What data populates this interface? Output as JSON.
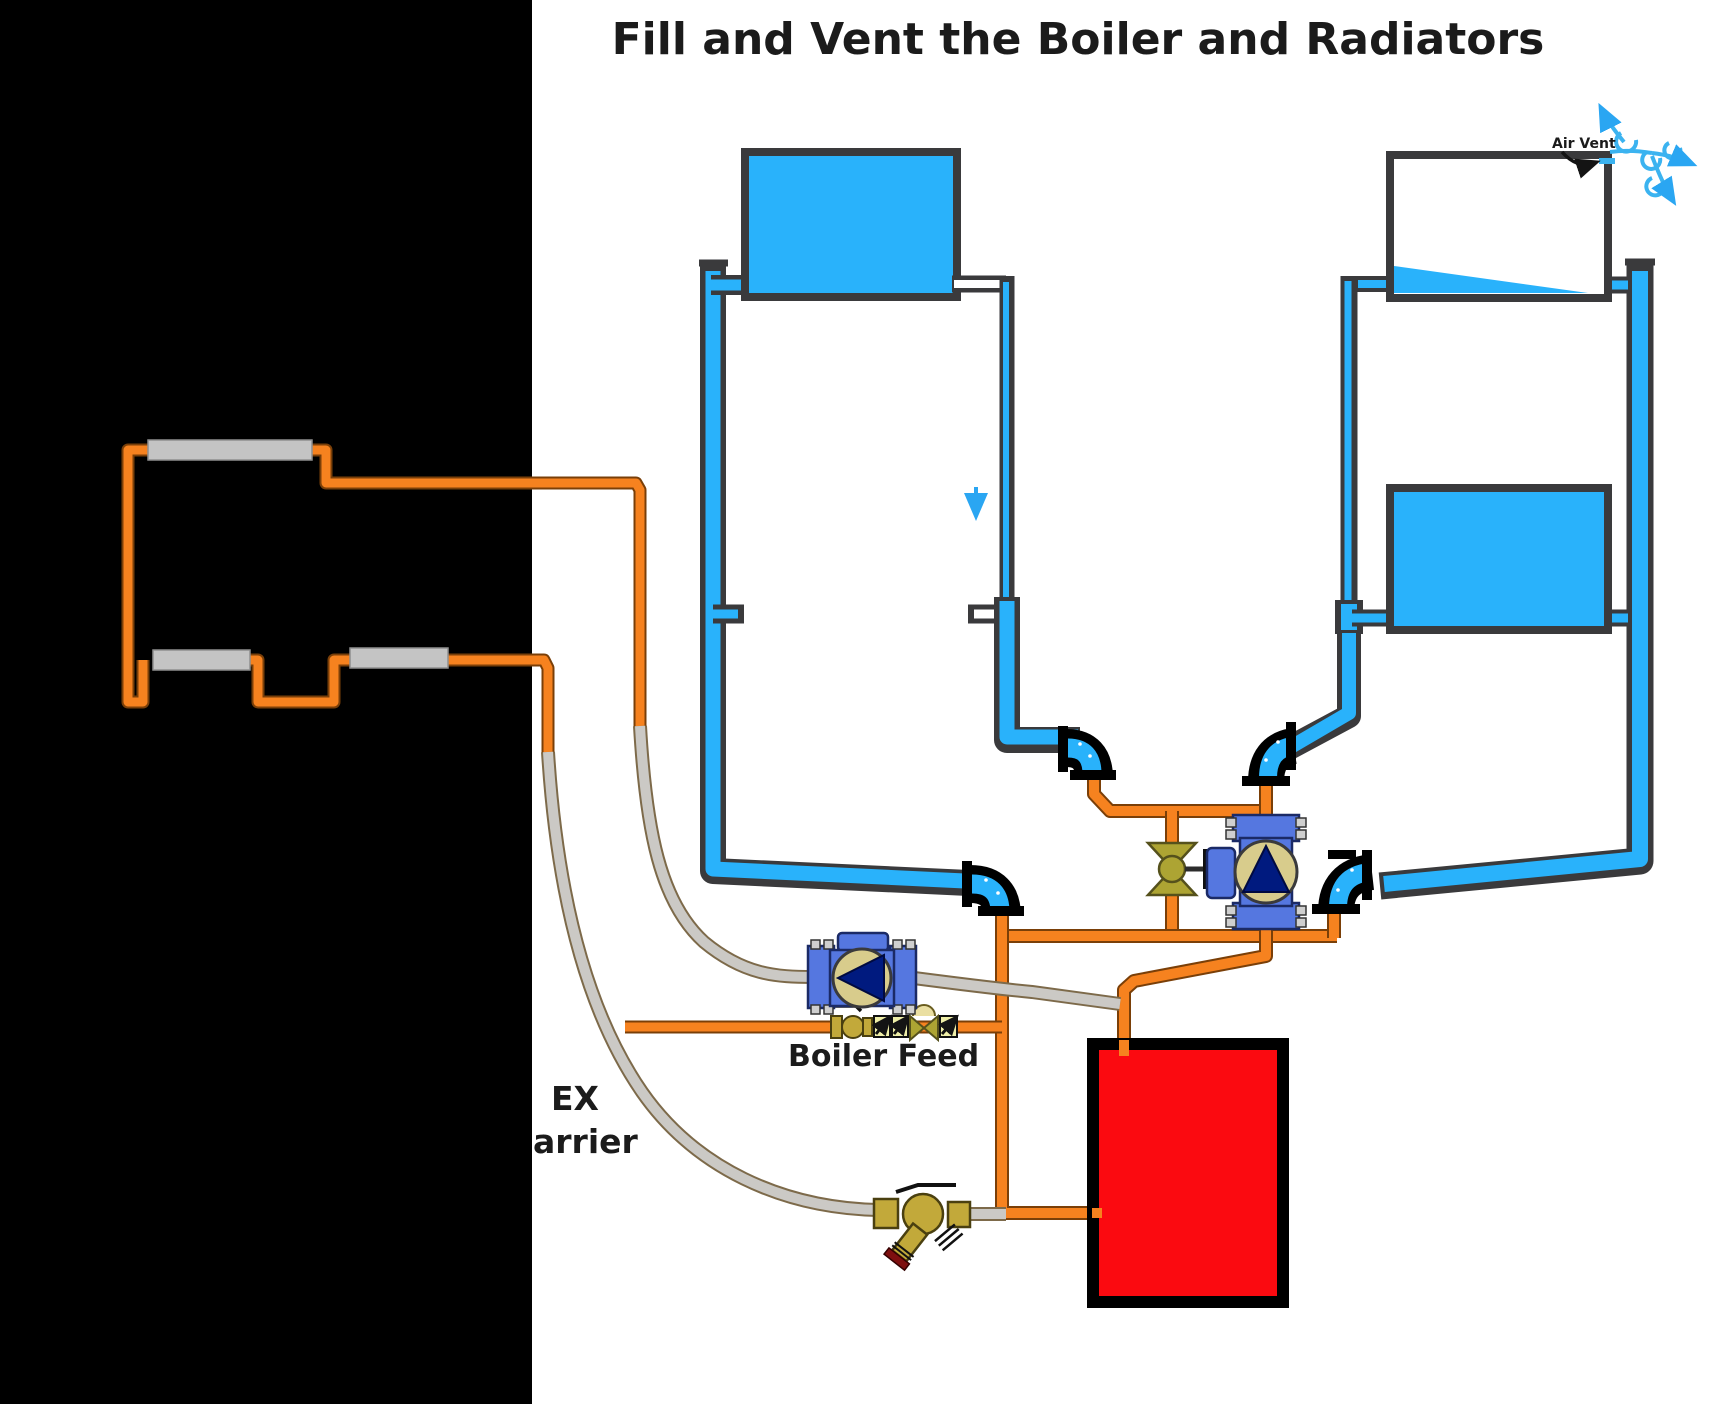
{
  "title": "Fill and Vent the Boiler and Radiators",
  "labels": {
    "air_vent": "Air Vent",
    "boiler_feed": "Boiler Feed",
    "pex_fragment_top": "EX",
    "pex_fragment_bottom": "arrier"
  },
  "legend": {
    "water_filled_pipe": "blue",
    "empty_pipe": "white",
    "supply_return_piping": "orange",
    "pex_tubing": "gray",
    "boiler": "red"
  },
  "colors": {
    "water_blue": "#29B2FB",
    "pipe_border": "#3A3A3C",
    "orange_pipe": "#F6821F",
    "orange_outline": "#7A3F08",
    "pex_gray": "#CBC9C5",
    "pex_outline": "#7D6A4A",
    "boiler_red": "#FB0A10",
    "valve_olive": "#ADA433",
    "brass": "#C2A93A",
    "pump_blue": "#5577E0",
    "pump_face_tan": "#D8CC8C",
    "pump_triangle_navy": "#001A7F",
    "check_valve_yellow": "#EFEFA8",
    "baseboard_gray": "#C4C4C4",
    "black_region": "#000000",
    "air_swirl_blue": "#3BB3F0"
  },
  "icons": [
    "air-vent-swirl-icon",
    "flow-down-arrow-icon",
    "air-vent-pointer-arrow-icon",
    "bowtie-valve-icon",
    "check-valve-icon",
    "pressure-reducing-valve-icon",
    "ball-valve-icon",
    "drain-valve-icon",
    "circulator-pump-icon",
    "pipe-elbow-fitting-icon"
  ]
}
